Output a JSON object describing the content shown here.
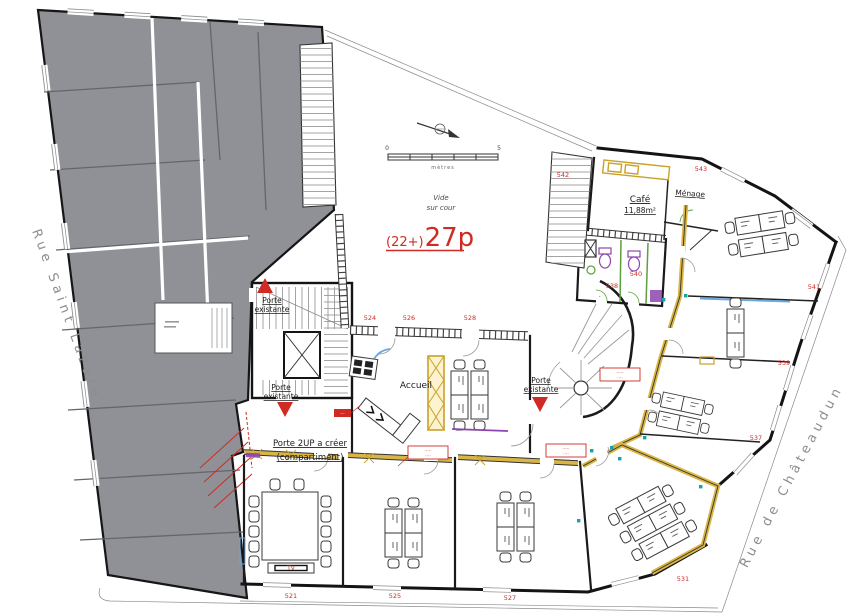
{
  "colors": {
    "accent_red": "#cf2b24",
    "wall_black": "#1a1a1a",
    "gray_building": "#8f9196",
    "yellow_partition": "#c9a227",
    "green_fixture": "#5f9e3e",
    "purple_fixture": "#8e44ad",
    "blue_glazing": "#6ea6d8",
    "teal_marker": "#17a2a8",
    "street_text": "#8d8d8d"
  },
  "streets": {
    "left": "Rue Saint Lazare",
    "right": "Rue de Châteaudun"
  },
  "courtyard": {
    "line1": "Vide",
    "line2": "sur cour"
  },
  "capacity": {
    "prefix": "(22+)",
    "main": "27p"
  },
  "scalebar": {
    "start": "0",
    "end": "5",
    "unit": "mètres"
  },
  "labels": {
    "accueil": "Accueil",
    "cafe": "Café",
    "cafe_area": "11,88m²",
    "menage": "Ménage",
    "tv": "TV",
    "porte_line1": "Porte",
    "porte_line2": "existante",
    "note_2up_line1": "Porte 2UP a créer",
    "note_2up_line2": "(compartiment)"
  },
  "numbers": {
    "n521": "521",
    "n524": "524",
    "n525": "525",
    "n526": "526",
    "n527": "527",
    "n528": "528",
    "n531": "531",
    "n537": "537",
    "n538": "538",
    "n539": "539",
    "n540": "540",
    "n541": "541",
    "n542": "542",
    "n543": "543"
  },
  "tags": {
    "solid": "···",
    "box1_l1": "·····",
    "box1_l2": "····",
    "box2_l1": "·····",
    "box2_l2": "····",
    "box3_l1": "·····",
    "box3_l2": "····"
  }
}
